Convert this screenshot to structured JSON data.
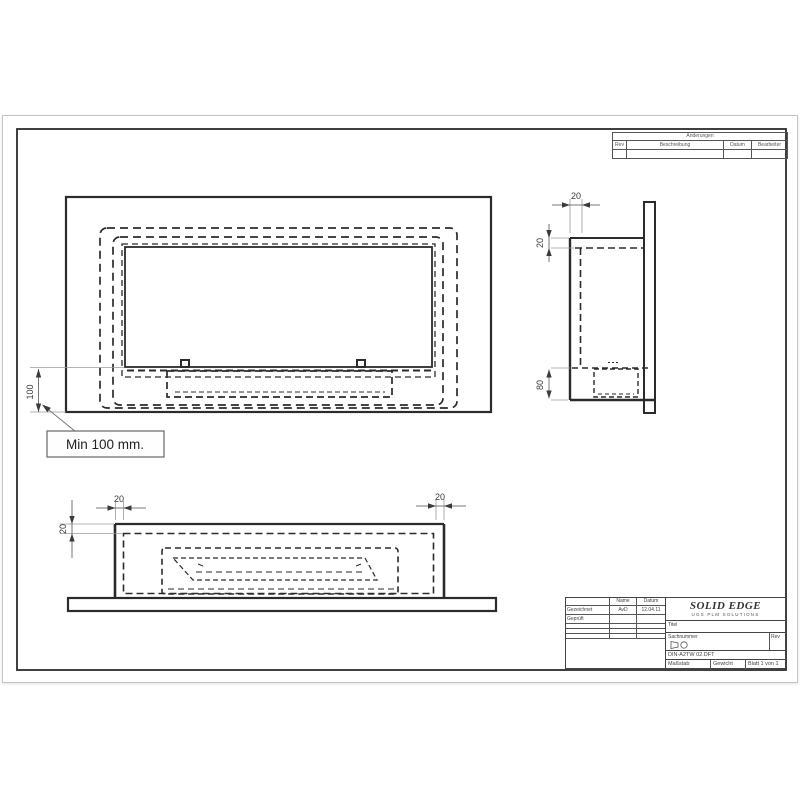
{
  "sheet": {
    "bg": "#ffffff",
    "line_color": "#2b2b2b",
    "frame_color": "#222222"
  },
  "revision_table": {
    "header": "Änderungen",
    "col_rev": "Rev",
    "col_desc": "Beschreibung",
    "col_date": "Datum",
    "col_by": "Bearbeiter"
  },
  "dimensions": {
    "front_offset": "100",
    "callout": "Min 100 mm.",
    "side_top_width": "20",
    "side_top_gap": "20",
    "side_bottom_depth": "80",
    "plan_left_wall": "20",
    "plan_right_wall": "20",
    "plan_top_wall": "20"
  },
  "title_block": {
    "name_header": "Name",
    "date_header": "Datum",
    "drawn_label": "Gezeichnet",
    "drawn_name": "AvD",
    "drawn_date": "12.04.11",
    "checked_label": "Geprüft",
    "logo_line1": "SOLID EDGE",
    "logo_line2": "UGS PLM SOLUTIONS",
    "title_label": "Titel",
    "doc_label": "Sachnummer",
    "rev_label": "Rev",
    "file_name": "DIN-A2TW 02.DFT",
    "scale_label": "Maßstab",
    "weight_label": "Gewicht",
    "sheet_label": "Blatt 1 von 1"
  }
}
